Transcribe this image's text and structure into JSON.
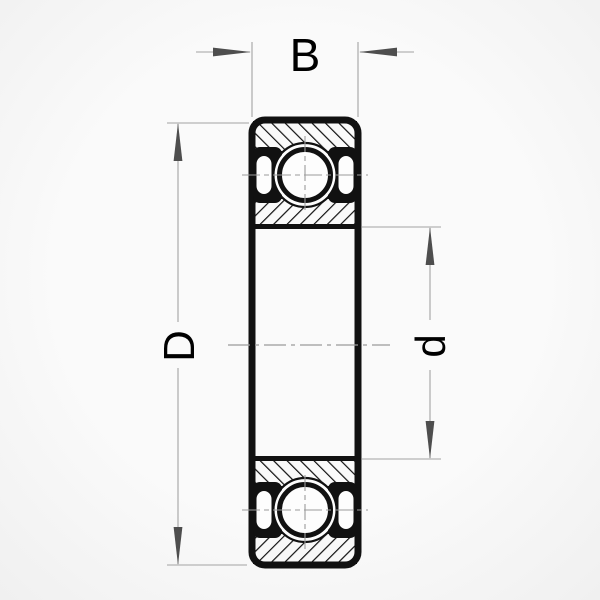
{
  "diagram": {
    "type": "deep-groove-ball-bearing-cross-section",
    "labels": {
      "width": "B",
      "outer_diameter": "D",
      "bore_diameter": "d"
    },
    "colors": {
      "drawing": "#111111",
      "dim_line": "#a3a3a3",
      "center_line": "#9b9b9b",
      "arrow": "#4e4e4e",
      "label_text": "#000000",
      "paper": "#fafafa",
      "fill_white": "#fdfdfd"
    }
  }
}
